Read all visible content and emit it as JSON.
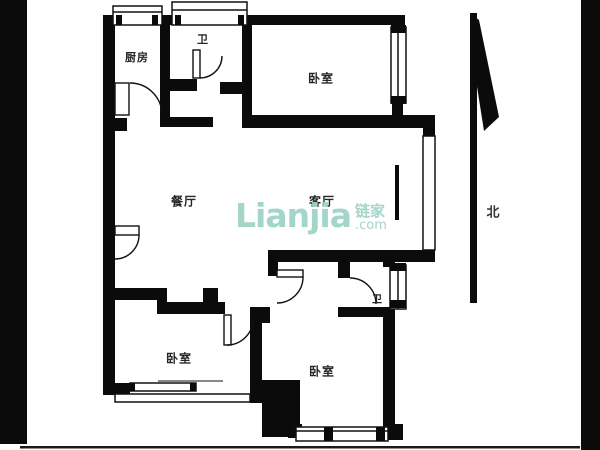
{
  "watermark": {
    "brand": "Lianjia",
    "brand_cn": "链家",
    "suffix": ".com",
    "color": "#9cd2c4"
  },
  "compass": {
    "north_label": "北"
  },
  "rooms": [
    {
      "id": "kitchen",
      "label": "厨房"
    },
    {
      "id": "bath-top",
      "label": "卫"
    },
    {
      "id": "bedroom-top-right",
      "label": "卧室"
    },
    {
      "id": "dining-room",
      "label": "餐厅"
    },
    {
      "id": "living-room",
      "label": "客厅"
    },
    {
      "id": "bedroom-bottom-left",
      "label": "卧室"
    },
    {
      "id": "bath-bottom",
      "label": "卫"
    },
    {
      "id": "bedroom-bottom-right",
      "label": "卧室"
    }
  ],
  "colors": {
    "wall": "#0b0b0b",
    "background": "#ffffff",
    "label": "#262626",
    "watermark": "#9cd2c4"
  }
}
